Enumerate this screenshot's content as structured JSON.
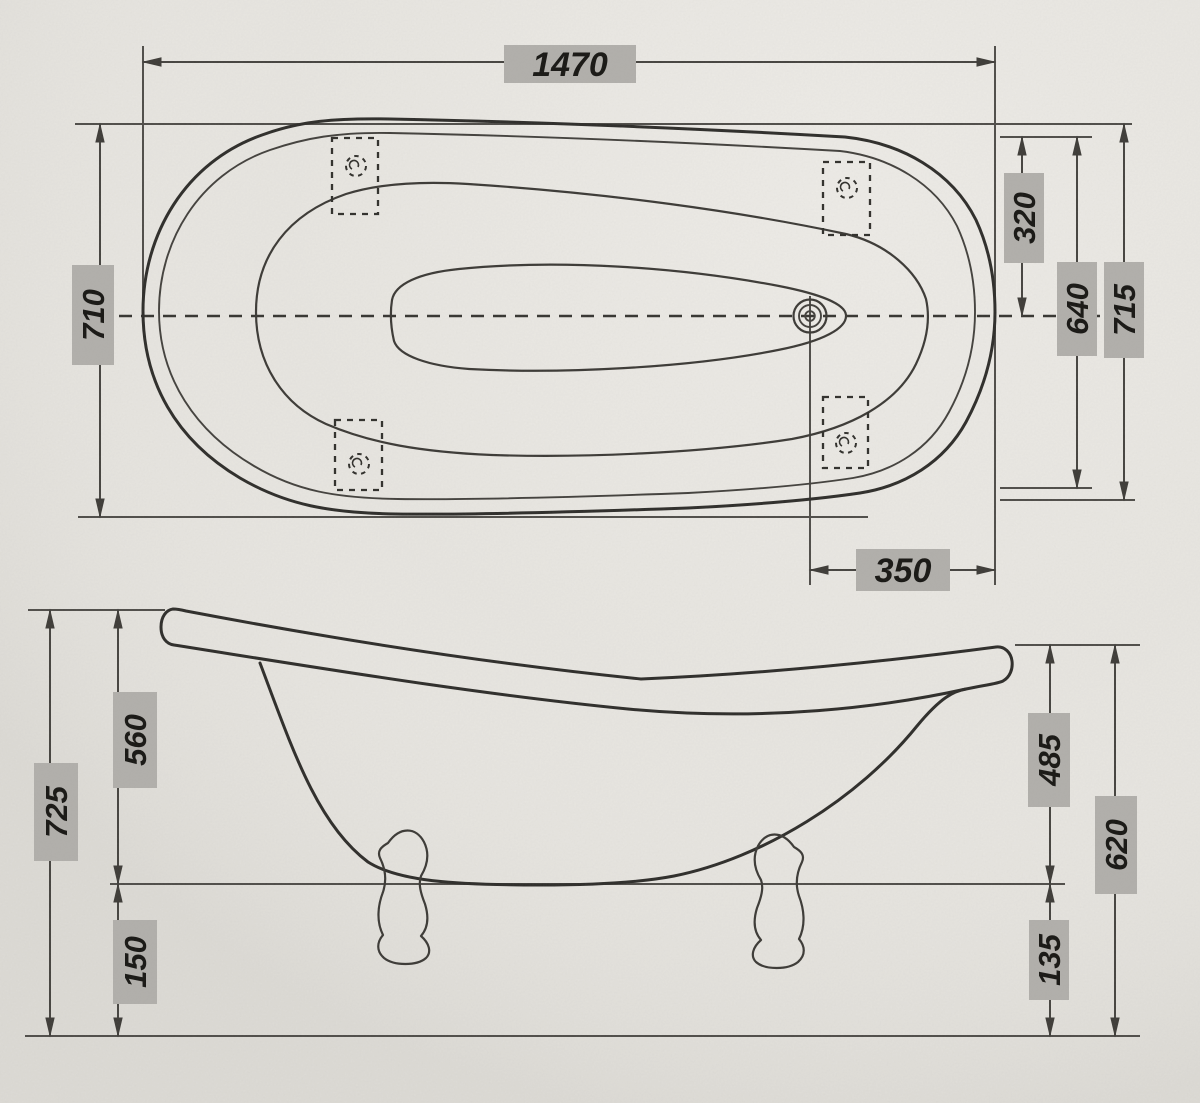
{
  "drawing": {
    "kind": "bathtub-dimension-drawing",
    "views": [
      "top-view",
      "side-view"
    ]
  },
  "dims": {
    "top": {
      "length": "1470",
      "width": "710",
      "half_width": "320",
      "inner_width": "640",
      "outer_width": "715",
      "drain_offset": "350"
    },
    "side": {
      "rim_to_base": "560",
      "total_height": "725",
      "floor_clearance": "150",
      "front_rim_to_base": "485",
      "front_height": "620",
      "front_floor_clearance": "135"
    }
  },
  "colors": {
    "paper": "#e9e7e2",
    "ink": "#2c2b28",
    "dimension_lines": "#44423e",
    "label_background": "#b2b0ac",
    "label_text": "#151411"
  }
}
